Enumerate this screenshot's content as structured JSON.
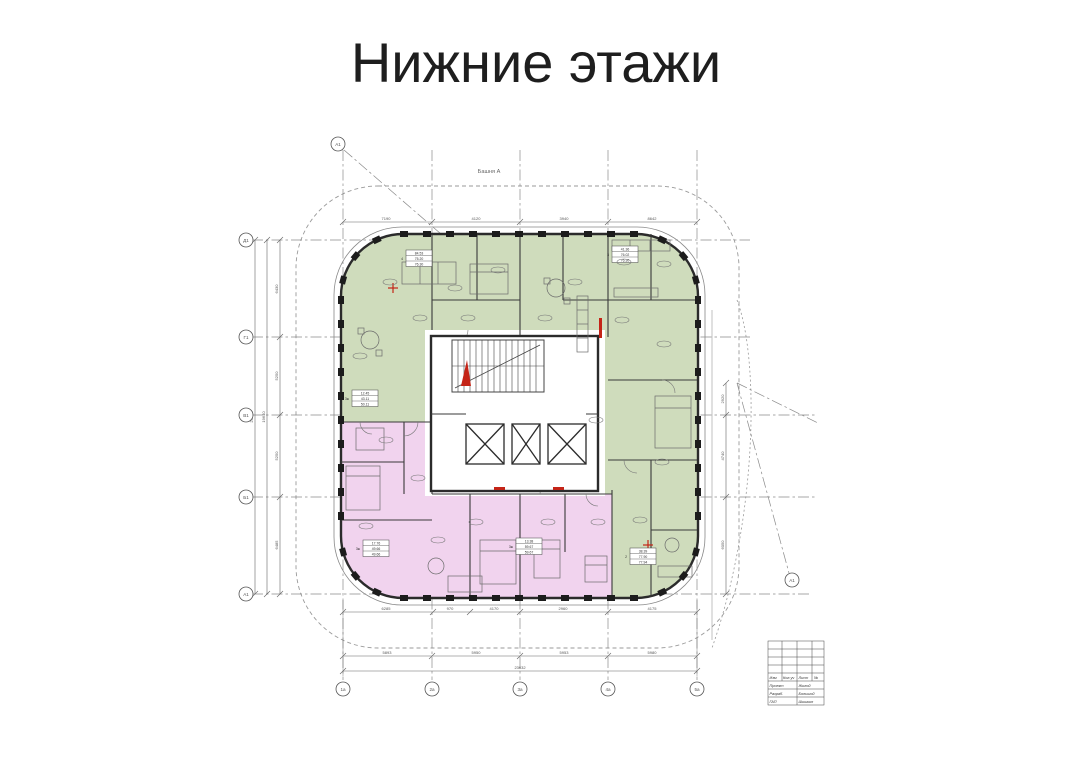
{
  "title": "Нижние этажи",
  "plan": {
    "building_label": "Башня А",
    "colors": {
      "green": "#cfdcbc",
      "pink": "#f1d3ee",
      "wall": "#2b2b2b",
      "red": "#c42417",
      "grid": "#8a8a8a"
    },
    "axes": {
      "left": [
        "Д1",
        "Г1",
        "В1",
        "Б1",
        "А1"
      ],
      "bottom": [
        "1а",
        "2а",
        "3а",
        "4а",
        "5а"
      ],
      "diag_top": "А1",
      "diag_right": "А1"
    },
    "dims": {
      "top": [
        "7190",
        "4120",
        "3940",
        "8642"
      ],
      "bottom_inner": [
        "6285",
        "970",
        "4170",
        "2960",
        "4175"
      ],
      "bottom_axes": [
        "5893",
        "5950",
        "5953",
        "5980"
      ],
      "bottom_overall": "23632",
      "left_chain": [
        "6430",
        "5250",
        "5250",
        "6485"
      ],
      "left_mid": "19640",
      "left_overall": "25642",
      "right_chain": [
        "2920",
        "4740",
        "6050"
      ]
    },
    "units": [
      {
        "prefix": "4",
        "rows": [
          "84.53",
          "75.20",
          "76.30"
        ]
      },
      {
        "prefix": "3",
        "rows": [
          "41.36",
          "76.02",
          "76.30"
        ]
      },
      {
        "prefix": "3ж",
        "rows": [
          "12.45",
          "43.11",
          "50.11"
        ]
      },
      {
        "prefix": "3ж",
        "rows": [
          "17.76",
          "49.66",
          "49.66"
        ]
      },
      {
        "prefix": "3ж",
        "rows": [
          "13.38",
          "59.67",
          "59.67"
        ]
      },
      {
        "prefix": "2",
        "rows": [
          "38.39",
          "77.90",
          "77.94"
        ]
      }
    ],
    "title_block": {
      "headers": [
        "Изм",
        "Кол.уч",
        "Лист",
        "№"
      ],
      "rows": [
        [
          "Проект",
          "Жилой"
        ],
        [
          "Разраб.",
          "Большой"
        ],
        [
          "ГАП",
          "Шишкин"
        ]
      ]
    }
  }
}
